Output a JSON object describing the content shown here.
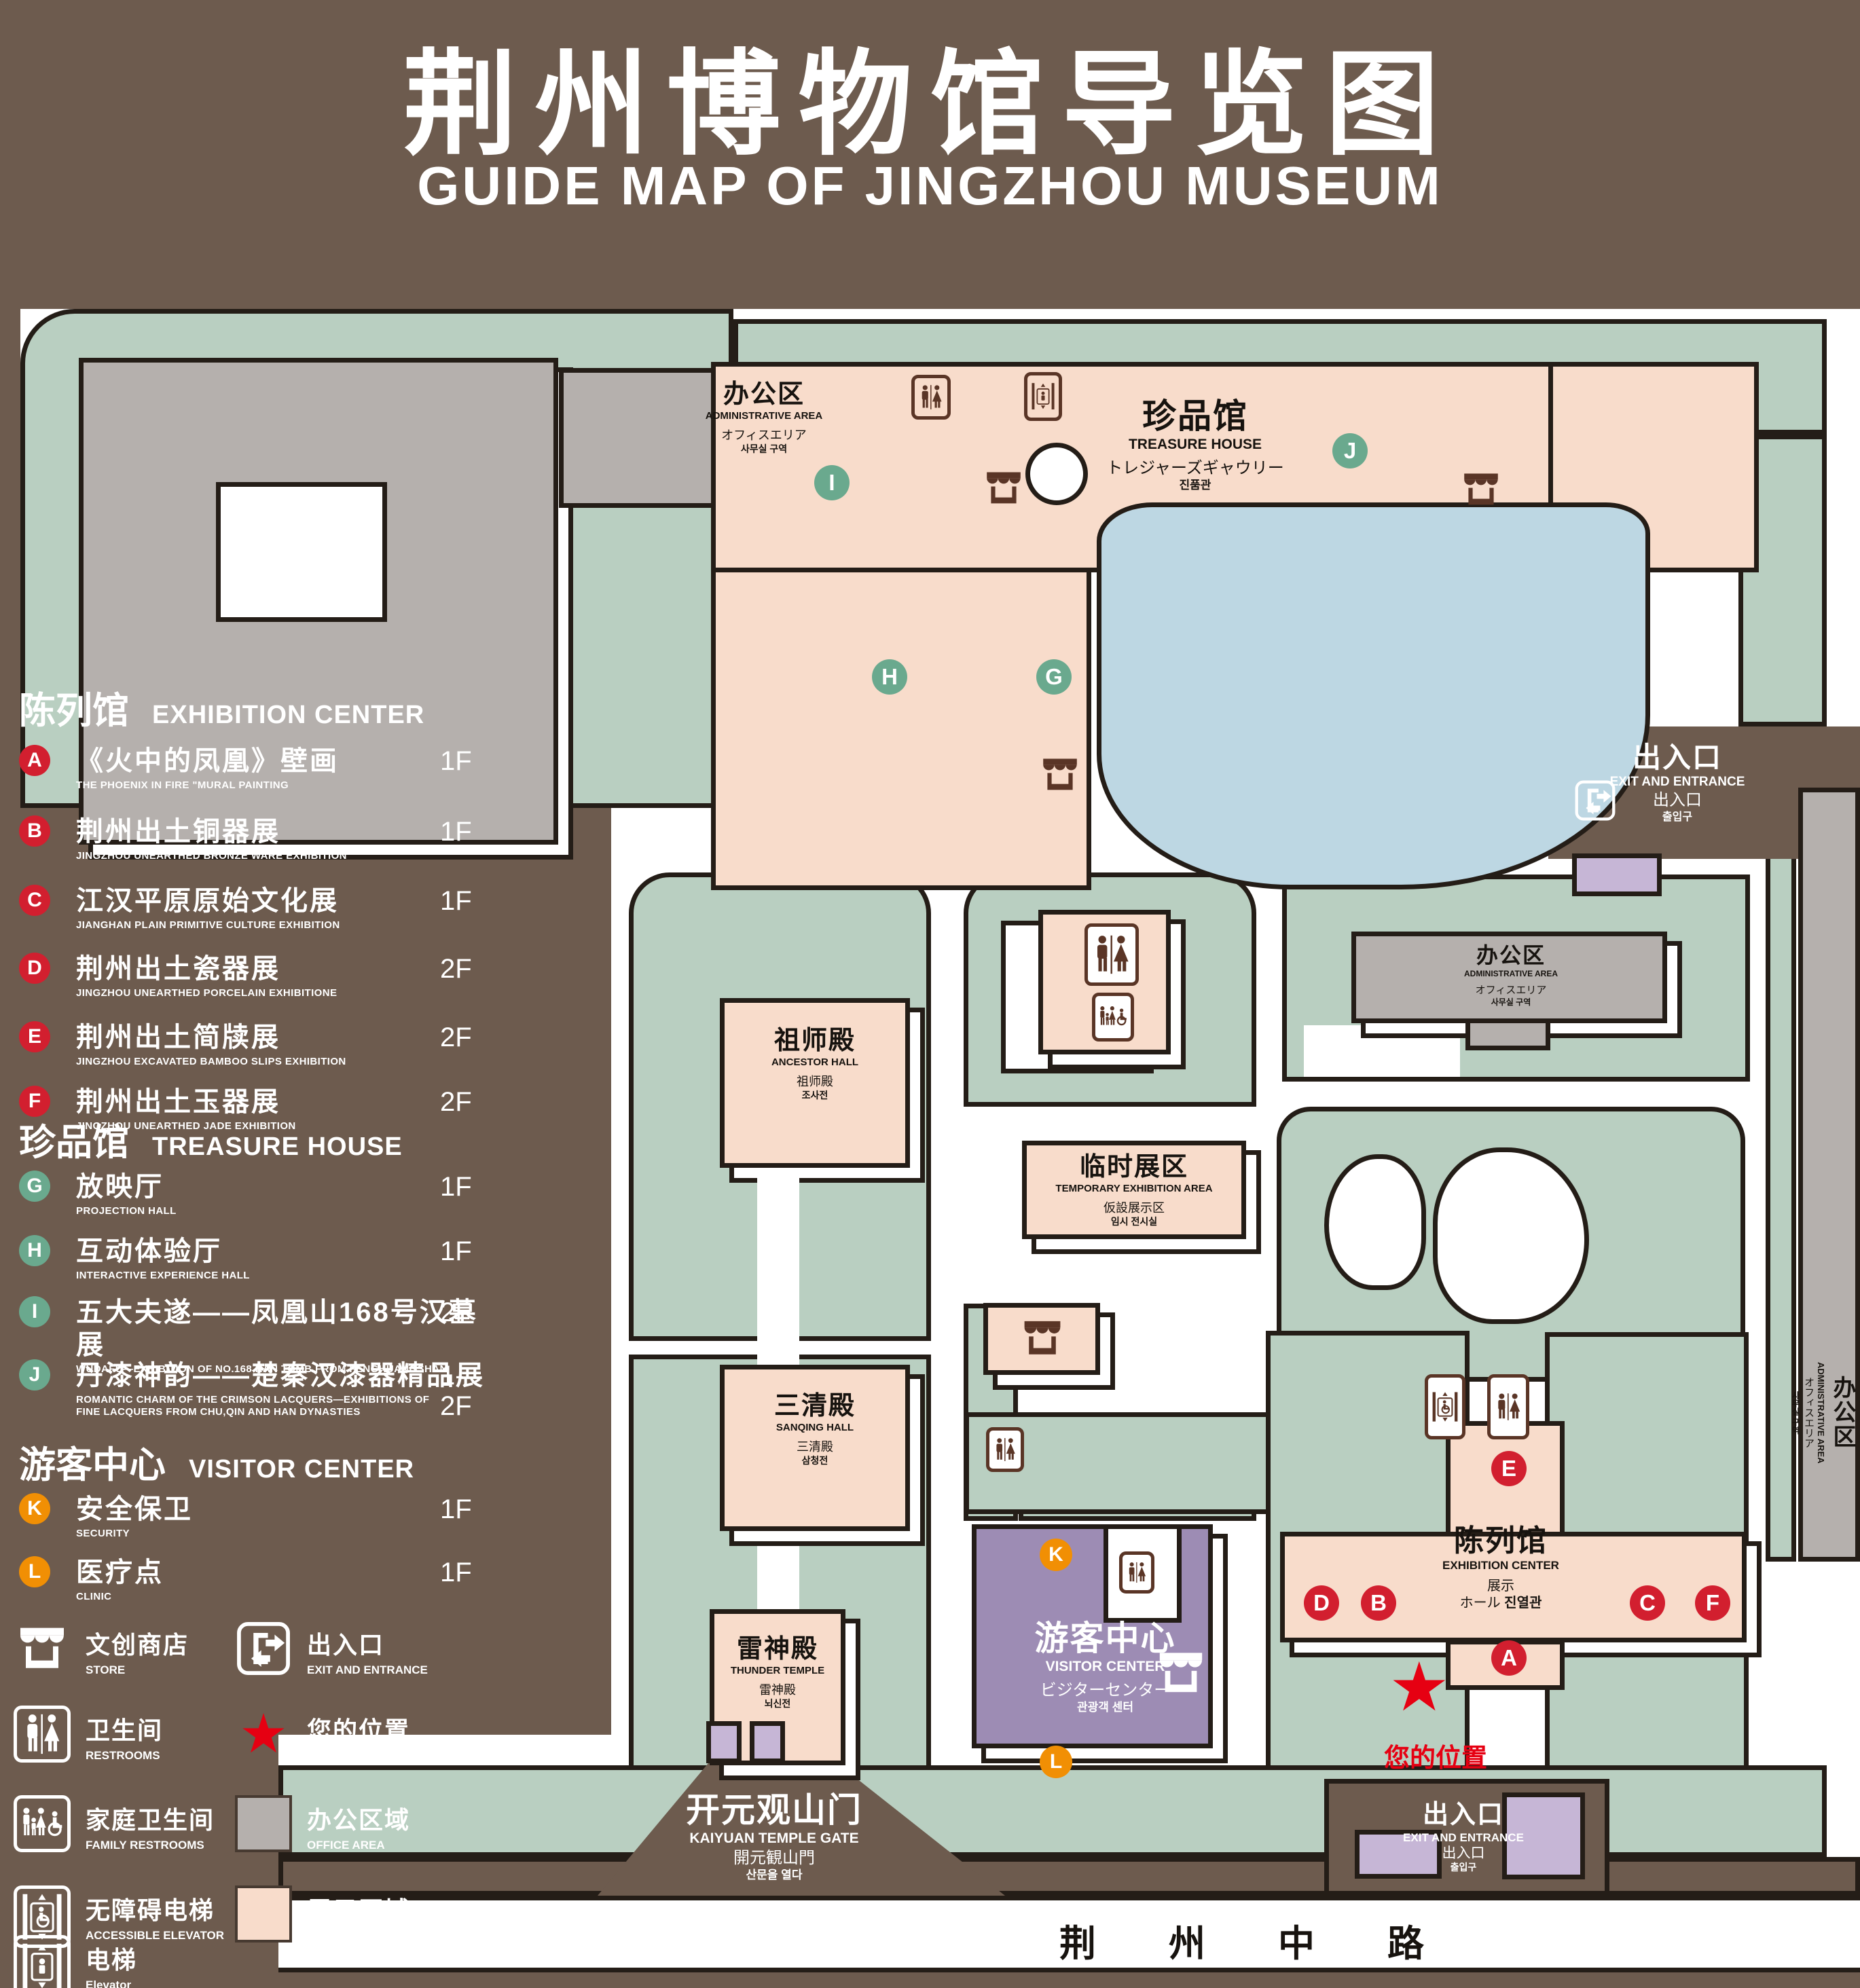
{
  "title": {
    "zh": "荆州博物馆导览图",
    "en": "GUIDE MAP OF JINGZHOU MUSEUM"
  },
  "legend": {
    "sections": [
      {
        "zh": "陈列馆",
        "en": "EXHIBITION CENTER",
        "items": [
          {
            "key": "A",
            "zh": "《火中的凤凰》壁画",
            "en": "THE PHOENIX IN FIRE \"MURAL PAINTING",
            "floor": "1F"
          },
          {
            "key": "B",
            "zh": "荆州出土铜器展",
            "en": "JINGZHOU UNEARTHED BRONZE WARE EXHIBITION",
            "floor": "1F"
          },
          {
            "key": "C",
            "zh": "江汉平原原始文化展",
            "en": "JIANGHAN PLAIN PRIMITIVE CULTURE EXHIBITION",
            "floor": "1F"
          },
          {
            "key": "D",
            "zh": "荆州出土瓷器展",
            "en": "JINGZHOU UNEARTHED PORCELAIN EXHIBITIONE",
            "floor": "2F"
          },
          {
            "key": "E",
            "zh": "荆州出土简牍展",
            "en": "JINGZHOU EXCAVATED BAMBOO SLIPS EXHIBITION",
            "floor": "2F"
          },
          {
            "key": "F",
            "zh": "荆州出土玉器展",
            "en": "JINGZHOU UNEARTHED JADE EXHIBITION",
            "floor": "2F"
          }
        ]
      },
      {
        "zh": "珍品馆",
        "en": "TREASURE HOUSE",
        "items": [
          {
            "key": "G",
            "zh": "放映厅",
            "en": "PROJECTION HALL",
            "floor": "1F"
          },
          {
            "key": "H",
            "zh": "互动体验厅",
            "en": "INTERACTIVE EXPERIENCE HALL",
            "floor": "1F"
          },
          {
            "key": "I",
            "zh": "五大夫遂——凤凰山168号汉墓展",
            "en": "WUDAFU—EXHIBITION OF NO.168 HAN TOMB FROM FENGHUANGSHAN",
            "floor": "2F"
          },
          {
            "key": "J",
            "zh": "丹漆神韵——楚秦汉漆器精品展",
            "en": "ROMANTIC CHARM OF THE CRIMSON LACQUERS—EXHIBITIONS OF FINE LACQUERS FROM CHU,QIN AND HAN DYNASTIES",
            "floor": "1-2F"
          }
        ]
      },
      {
        "zh": "游客中心",
        "en": "VISITOR CENTER",
        "items": [
          {
            "key": "K",
            "zh": "安全保卫",
            "en": "SECURITY",
            "floor": "1F"
          },
          {
            "key": "L",
            "zh": "医疗点",
            "en": "CLINIC",
            "floor": "1F"
          }
        ]
      }
    ],
    "symbols": [
      {
        "zh": "文创商店",
        "en": "STORE"
      },
      {
        "zh": "出入口",
        "en": "EXIT AND ENTRANCE"
      },
      {
        "zh": "卫生间",
        "en": "RESTROOMS"
      },
      {
        "zh": "您的位置",
        "en": "YOUR LOCATION"
      },
      {
        "zh": "家庭卫生间",
        "en": "FAMILY RESTROOMS"
      },
      {
        "zh": "办公区域",
        "en": "OFFICE AREA"
      },
      {
        "zh": "无障碍电梯",
        "en": "ACCESSIBLE ELEVATOR"
      },
      {
        "zh": "展示区域",
        "en": "DISPLAY AREA"
      },
      {
        "zh": "电梯",
        "en": "Elevator"
      }
    ]
  },
  "map": {
    "admin_nw": {
      "zh": "办公区",
      "en": "ADMINISTRATIVE AREA",
      "ja": "オフィスエリア",
      "ko": "사무실 구역"
    },
    "treasure": {
      "zh": "珍品馆",
      "en": "TREASURE HOUSE",
      "ja": "トレジャーズギャウリー",
      "ko": "진품관"
    },
    "ancestor": {
      "zh": "祖师殿",
      "en": "ANCESTOR HALL",
      "zh2": "祖师殿",
      "ko": "조사전"
    },
    "sanqing": {
      "zh": "三清殿",
      "en": "SANQING HALL",
      "zh2": "三清殿",
      "ko": "삼청전"
    },
    "thunder": {
      "zh": "雷神殿",
      "en": "THUNDER TEMPLE",
      "zh2": "雷神殿",
      "ko": "뇌신전"
    },
    "temporary": {
      "zh": "临时展区",
      "en": "TEMPORARY EXHIBITION AREA",
      "ja": "仮設展示区",
      "ko": "임시 전시실"
    },
    "admin_mid": {
      "zh": "办公区",
      "en": "ADMINISTRATIVE AREA",
      "ja": "オフィスエリア",
      "ko": "사무실 구역"
    },
    "admin_right": {
      "zh": "办公区",
      "en": "ADMINISTRATIVE AREA",
      "ja": "オフィスエリア",
      "ko": "사무실 구역"
    },
    "visitor": {
      "zh": "游客中心",
      "en": "VISITOR CENTER",
      "ja": "ビジターセンター",
      "ko": "관광객 센터"
    },
    "exhibition": {
      "zh": "陈列馆",
      "en": "EXHIBITION CENTER",
      "ja": "展示",
      "ja2": "ホール",
      "ko": "진열관"
    },
    "exit_ne": {
      "zh": "出入口",
      "en": "EXIT AND ENTRANCE",
      "zh2": "出入口",
      "ko": "출입구"
    },
    "exit_s": {
      "zh": "出入口",
      "en": "EXIT AND ENTRANCE",
      "zh2": "出入口",
      "ko": "출입구"
    },
    "gate": {
      "zh": "开元观山门",
      "en": "KAIYUAN TEMPLE GATE",
      "ja": "開元観山門",
      "ko": "산문을 열다"
    },
    "road": "荆 州 中 路",
    "your_location": "您的位置"
  },
  "colors": {
    "background": "#6d5b4e",
    "lawn_green": "#b9cfc1",
    "display_pink": "#f8dccb",
    "office_gray": "#b5b0ad",
    "visitor_purple": "#9d8cb4",
    "entrance_purple": "#c6b6d6",
    "lake_blue": "#bdd7e3",
    "marker_red": "#d21f2f",
    "marker_green": "#6aa98e",
    "marker_orange": "#f18f04",
    "location_red": "#e60012",
    "outline": "#241d17"
  }
}
